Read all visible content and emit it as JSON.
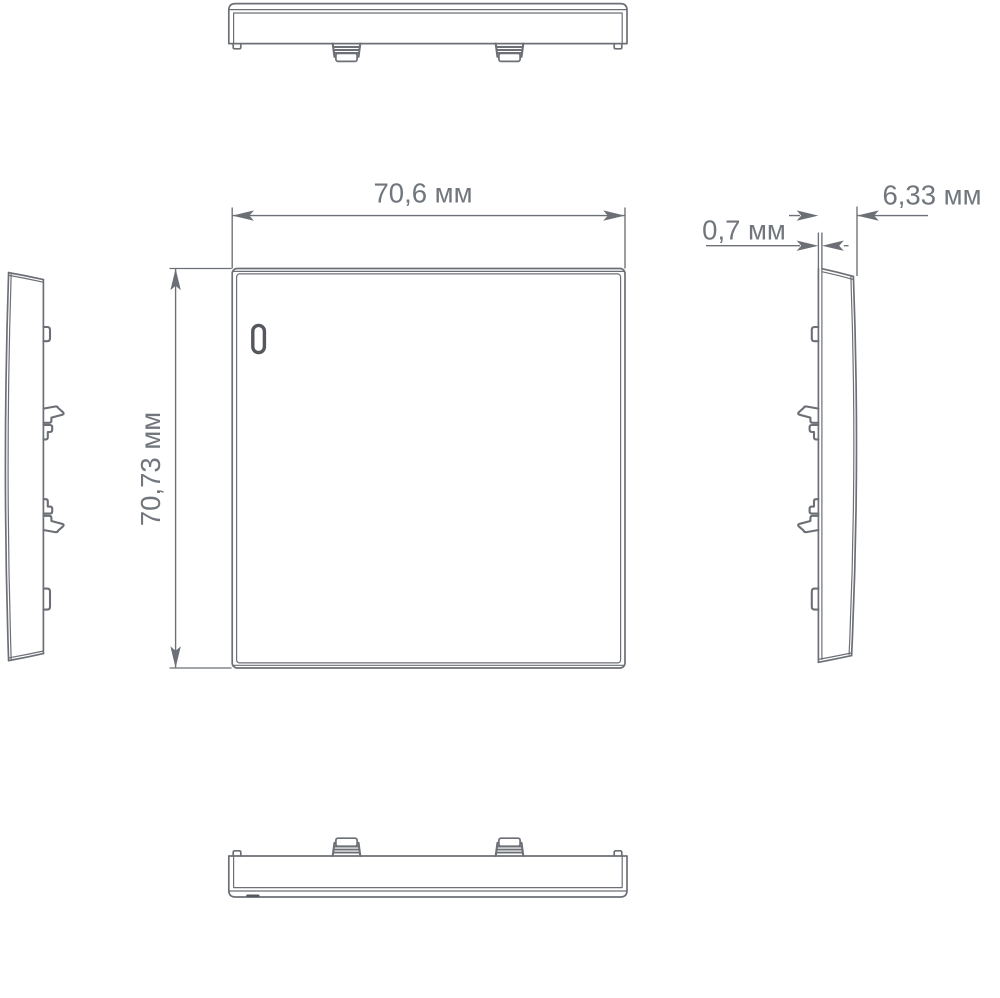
{
  "colors": {
    "line": "#6c7076",
    "text": "#71767c",
    "dark": "#54575b",
    "background": "#ffffff"
  },
  "dimensions": {
    "width": "70,6 мм",
    "height": "70,73 мм",
    "edge_thickness": "0,7 мм",
    "depth": "6,33 мм"
  }
}
